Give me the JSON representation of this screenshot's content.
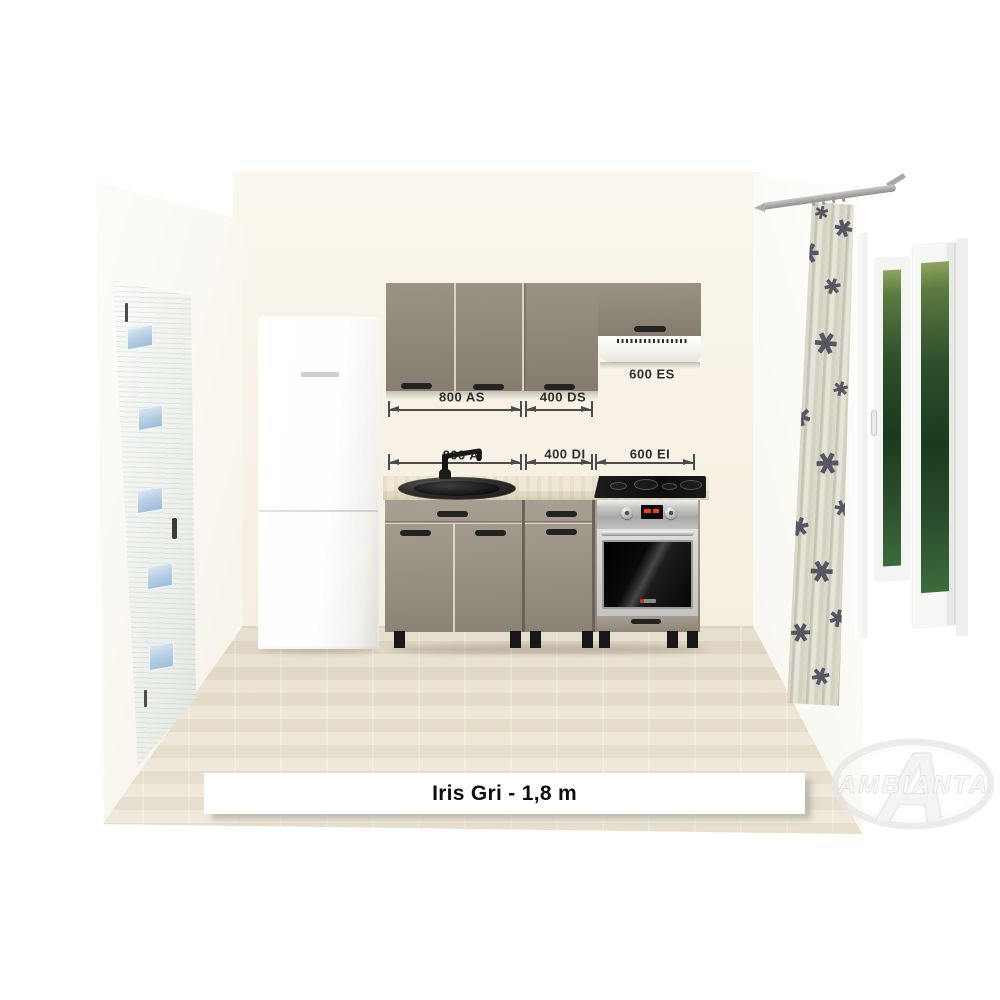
{
  "title_bar": {
    "text": "Iris Gri - 1,8 m"
  },
  "watermark": {
    "text": "AMBIANTA",
    "monogram": "A"
  },
  "annotations": {
    "upper": [
      {
        "code": "800 AS",
        "meaning": "wall cabinet 800"
      },
      {
        "code": "400 DS",
        "meaning": "wall cabinet 400"
      },
      {
        "code": "600 ES",
        "meaning": "hood section 600"
      }
    ],
    "lower": [
      {
        "code": "800 AI",
        "meaning": "base cabinet 800"
      },
      {
        "code": "400 DI",
        "meaning": "base drawer unit 400"
      },
      {
        "code": "600 EI",
        "meaning": "oven section 600"
      }
    ]
  },
  "curtain": {
    "flower_glyph": "✱"
  },
  "icons": {
    "fridge_brand_mark": "fridge-brand-mark",
    "oven_brand_mark": "oven-brand-mark"
  },
  "colors": {
    "cabinet_taupe": "#8F887C",
    "countertop": "#E9E1CD",
    "floor": "#E8E0CF",
    "back_wall": "#F8F3E7",
    "window_glass_green": "#23432A",
    "curtain_fabric": "#DCD8C9",
    "curtain_flower": "#4B4B59",
    "sink_graphite": "#1F1F1F",
    "oven_steel": "#C9C9C7",
    "dimension_text": "#2E2E2E"
  }
}
